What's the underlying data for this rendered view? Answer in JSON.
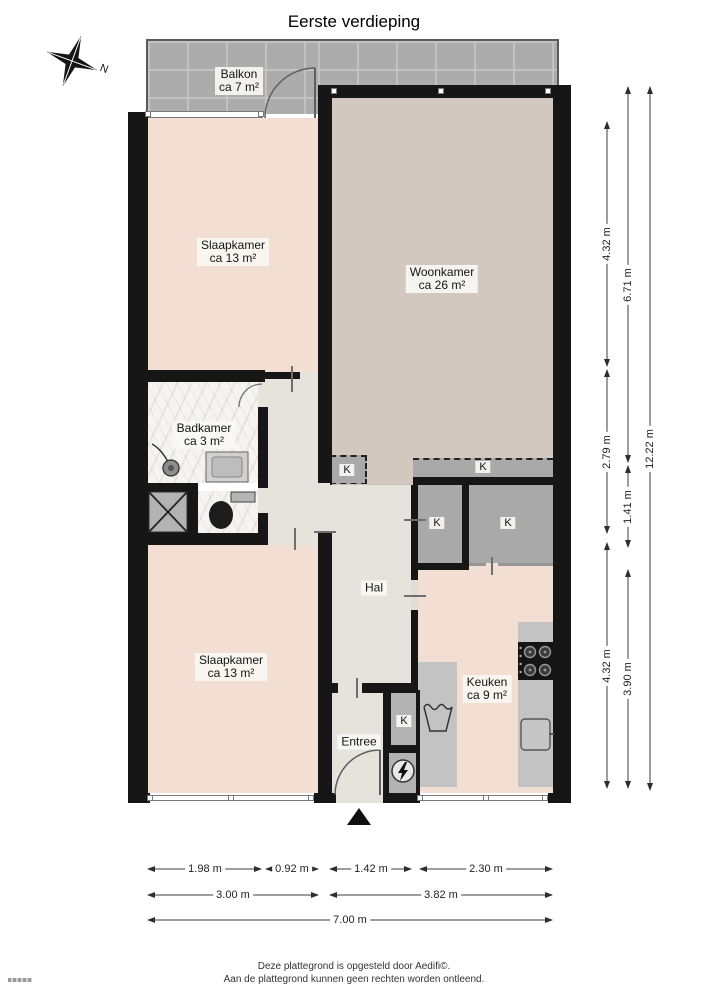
{
  "title": "Eerste verdieping",
  "compass": {
    "north_label": "N"
  },
  "rooms": [
    {
      "id": "balkon",
      "name": "Balkon",
      "area": "ca 7 m²"
    },
    {
      "id": "slaapkamer1",
      "name": "Slaapkamer",
      "area": "ca 13 m²"
    },
    {
      "id": "woonkamer",
      "name": "Woonkamer",
      "area": "ca 26 m²"
    },
    {
      "id": "badkamer",
      "name": "Badkamer",
      "area": "ca 3 m²"
    },
    {
      "id": "hal",
      "name": "Hal",
      "area": ""
    },
    {
      "id": "slaapkamer2",
      "name": "Slaapkamer",
      "area": "ca 13 m²"
    },
    {
      "id": "keuken",
      "name": "Keuken",
      "area": "ca 9 m²"
    },
    {
      "id": "entree",
      "name": "Entree",
      "area": ""
    }
  ],
  "closets": {
    "label": "K"
  },
  "dimensions": {
    "right": [
      {
        "label": "4.32 m"
      },
      {
        "label": "2.79 m"
      },
      {
        "label": "4.32 m"
      },
      {
        "label": "6.71 m"
      },
      {
        "label": "1.41 m"
      },
      {
        "label": "3.90 m"
      },
      {
        "label": "12.22 m"
      }
    ],
    "bottom": [
      {
        "label": "1.98 m"
      },
      {
        "label": "0.92 m"
      },
      {
        "label": "1.42 m"
      },
      {
        "label": "2.30 m"
      },
      {
        "label": "3.00 m"
      },
      {
        "label": "3.82 m"
      },
      {
        "label": "7.00 m"
      }
    ]
  },
  "footer": {
    "line1": "Deze plattegrond is opgesteld door Aedifi©.",
    "line2": "Aan de plattegrond kunnen geen rechten worden ontleend."
  },
  "colors": {
    "wall": "#161616",
    "floor_bedroom_kitchen": "#f3ded3",
    "floor_living": "#d3c8bf",
    "floor_hall": "#e6e3dd",
    "floor_bath": "#f6f4f1",
    "closet_fill": "#a9a9a9",
    "balcony_tile": "#acacac"
  }
}
